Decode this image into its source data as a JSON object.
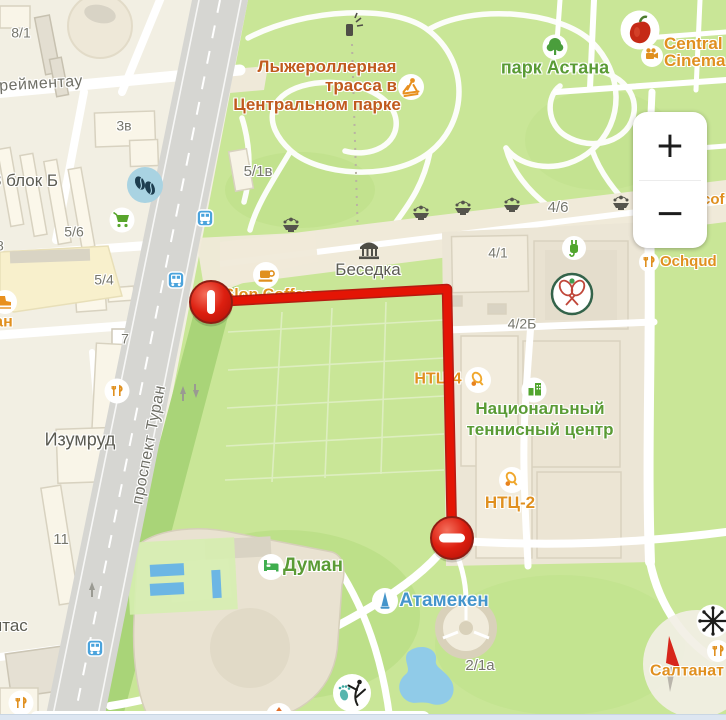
{
  "controls": {
    "zoom_in": "+",
    "zoom_out": "−"
  },
  "colors": {
    "route_red": "#e41505",
    "poi_orange": "#e0901f",
    "green_label": "#5a9b35",
    "blue_label": "#4595cb",
    "park_title_brown": "#c05a1d",
    "water": "#90cbe8"
  },
  "map": {
    "streets": {
      "yereimentau": "Ерейментау",
      "turan": "проспект Туран"
    },
    "district_labels": {
      "izumrud": "Изумруд",
      "ytas_fragment": "ытас",
      "park_astana": "парк Астана",
      "duman": "Думан",
      "atameken": "Атамекен",
      "saltanat": "Салтанат",
      "besedka": "Беседка"
    },
    "park_title": {
      "line1": "Лыжероллерная",
      "line2": "трасса в",
      "line3": "Центральном парке"
    },
    "poi_labels": {
      "central_cinema_line1": "Central",
      "central_cinema_line2": "Cinema",
      "cof_fragment": "cof",
      "ochqud_fragment": "Ochqud",
      "slon_coffee": "Slon Coffee",
      "ntc4": "НТЦ-4",
      "ntc2": "НТЦ-2",
      "national_tennis_line1": "Национальный",
      "national_tennis_line2": "теннисный центр",
      "lan_fragment": "лан"
    },
    "building_numbers": {
      "b81": "8/1",
      "b3v": "3в",
      "block_b": "3 блок Б",
      "b56": "5/6",
      "b8": "8",
      "b54": "5/4",
      "b7": "7",
      "b11": "11",
      "b51v": "5/1в",
      "b46": "4/6",
      "b41": "4/1",
      "b42b": "4/2Б",
      "b21a": "2/1а"
    }
  }
}
